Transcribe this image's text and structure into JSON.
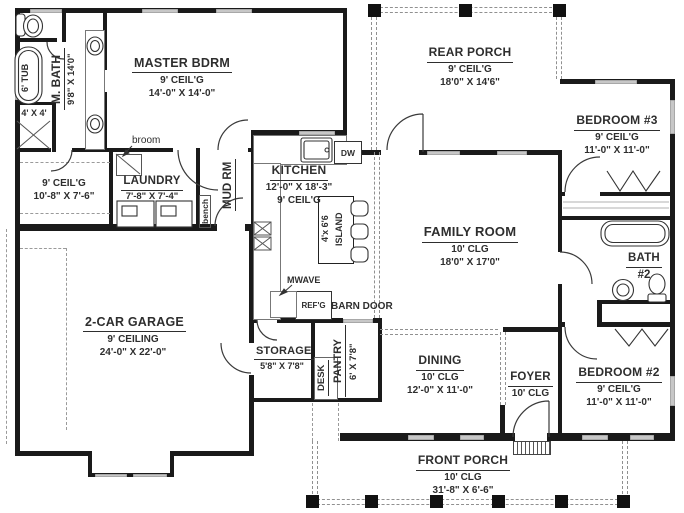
{
  "rooms": {
    "master_bdrm": {
      "name": "MASTER BDRM",
      "ceil": "9' CEIL'G",
      "dims": "14'-0\" X 14'-0\""
    },
    "rear_porch": {
      "name": "REAR PORCH",
      "ceil": "9' CEIL'G",
      "dims": "18'0\" X 14'6\""
    },
    "bedroom3": {
      "name": "BEDROOM #3",
      "ceil": "9' CEIL'G",
      "dims": "11'-0\" X 11'-0\""
    },
    "m_bath": {
      "name": "M. BATH",
      "dims": "9'8\" X 14'0\""
    },
    "m_closet": {
      "ceil": "9' CEIL'G",
      "dims": "10'-8\" X 7'-6\""
    },
    "laundry": {
      "name": "LAUNDRY",
      "dims": "7'-8\" X 7'-4\""
    },
    "mud_rm": {
      "name": "MUD RM"
    },
    "kitchen": {
      "name": "KITCHEN",
      "dims": "12'-0\" X 18'-3\"",
      "ceil": "9' CEIL'G"
    },
    "island": {
      "line1": "4'x 6'6",
      "line2": "ISLAND"
    },
    "family_room": {
      "name": "FAMILY ROOM",
      "ceil": "10' CLG",
      "dims": "18'0\" X 17'0\""
    },
    "bath2": {
      "name": "BATH",
      "num": "#2"
    },
    "garage": {
      "name": "2-CAR GARAGE",
      "ceil": "9' CEILING",
      "dims": "24'-0\" X 22'-0\""
    },
    "storage": {
      "name": "STORAGE",
      "dims": "5'8\" X 7'8\""
    },
    "pantry": {
      "name": "PANTRY",
      "dims": "6' X 7'8\""
    },
    "dining": {
      "name": "DINING",
      "ceil": "10' CLG",
      "dims": "12'-0\" X 11'-0\""
    },
    "foyer": {
      "name": "FOYER",
      "ceil": "10' CLG"
    },
    "bedroom2": {
      "name": "BEDROOM #2",
      "ceil": "9' CEIL'G",
      "dims": "11'-0\" X 11'-0\""
    },
    "front_porch": {
      "name": "FRONT PORCH",
      "ceil": "10' CLG",
      "dims": "31'-8\" X 6'-6\""
    }
  },
  "fixtures": {
    "tub": "6' TUB",
    "shower": "4' X 4'",
    "broom": "broom",
    "bench": "bench",
    "dw": "DW",
    "mwave": "MWAVE",
    "refg": "REF'G",
    "barn_door": "BARN DOOR",
    "desk": "DESK"
  },
  "colors": {
    "wall": "#1a1a1a",
    "window": "#c7c7c7",
    "dash": "#909090",
    "text": "#2e2e2e"
  }
}
